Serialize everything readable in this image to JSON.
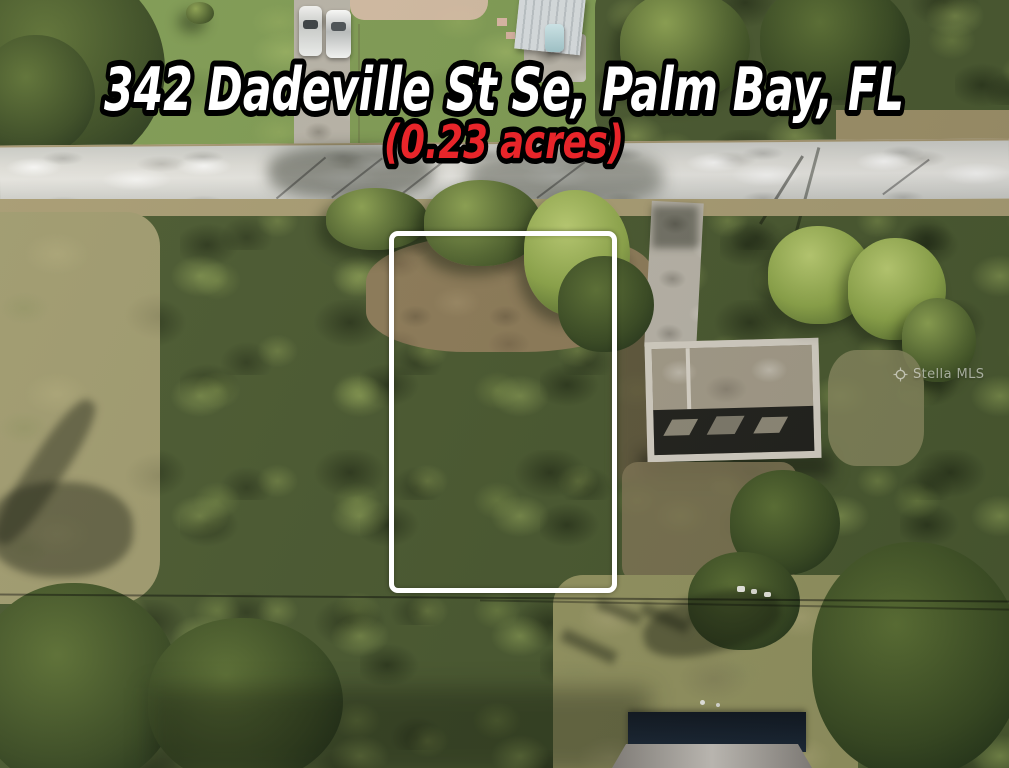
{
  "listing": {
    "address": "342 Dadeville St Se, Palm Bay, FL",
    "lot_size": "(0.23 acres)"
  },
  "watermark": {
    "text": "Stella MLS"
  },
  "colors": {
    "address_fill": "#ffffff",
    "lot_size_fill": "#e8252a",
    "text_outline": "#000000",
    "lot_outline": "#ffffff"
  }
}
